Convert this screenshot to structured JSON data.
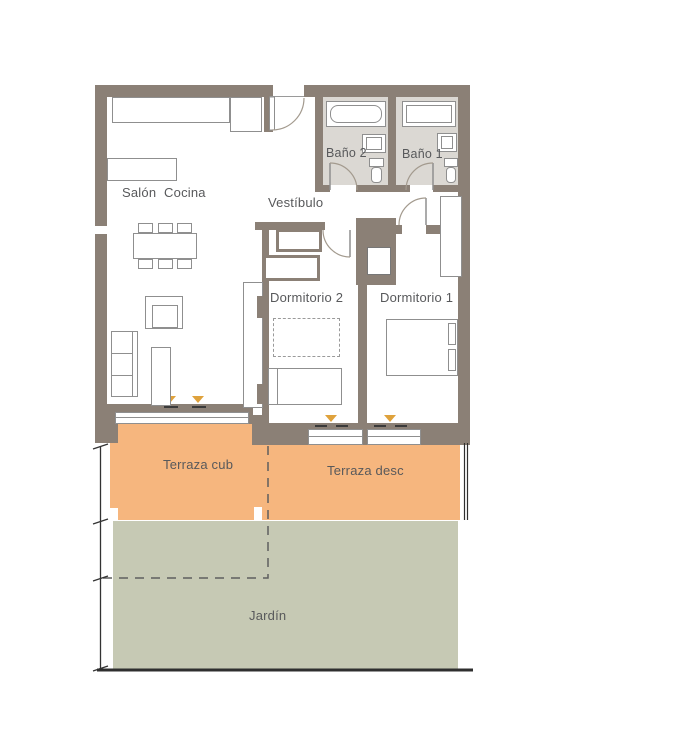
{
  "rooms": {
    "salon": {
      "label": "Salón Cocina"
    },
    "vestibulo": {
      "label": "Vestíbulo"
    },
    "bano2": {
      "label": "Baño 2"
    },
    "bano1": {
      "label": "Baño 1"
    },
    "dormitorio2": {
      "label": "Dormitorio 2"
    },
    "dormitorio1": {
      "label": "Dormitorio 1"
    },
    "terraza_cub": {
      "label": "Terraza cub"
    },
    "terraza_desc": {
      "label": "Terraza desc"
    },
    "jardin": {
      "label": "Jardín"
    }
  },
  "colors": {
    "wall": "#8b8076",
    "bath": "#dbd8d3",
    "terrace": "#f6b67e",
    "garden": "#c6c9b4",
    "marker": "#dfa23c",
    "text": "#58595b",
    "line": "#8f8f8f"
  }
}
